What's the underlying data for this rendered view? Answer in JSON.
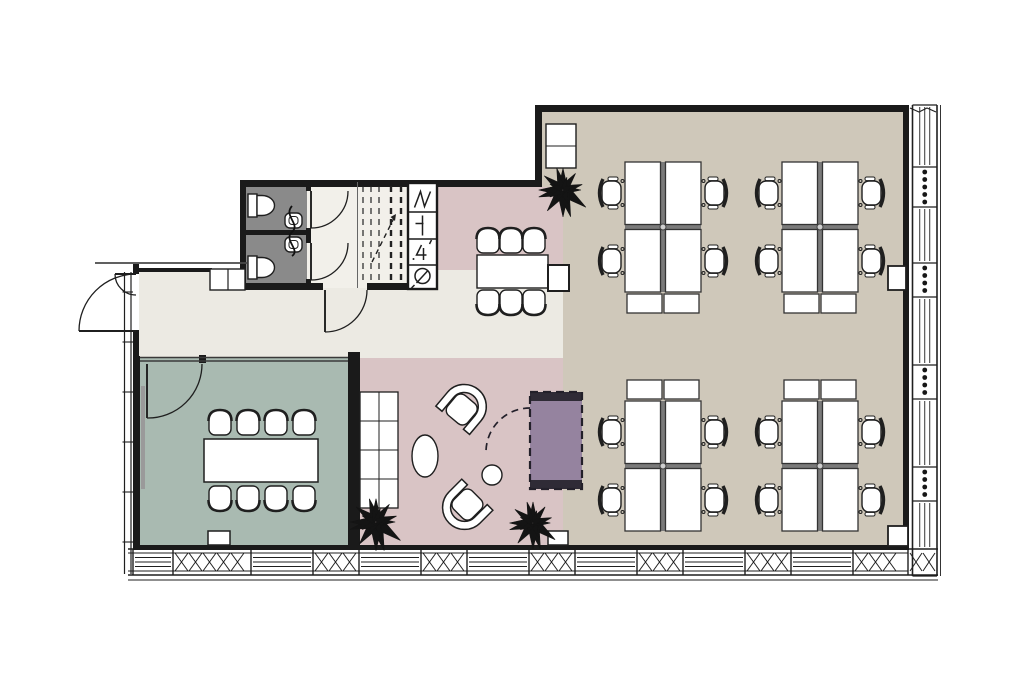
{
  "plan": {
    "canvas": {
      "width": 1024,
      "height": 683,
      "background": "#ffffff"
    },
    "palette": {
      "wall": "#1a1a1a",
      "line": "#1f1f1f",
      "office_floor": "#cfc8ba",
      "lounge_floor": "#d9c4c5",
      "meeting_floor": "#a9bab1",
      "corridor_floor": "#eceae3",
      "vestibule_floor": "#f2f0ea",
      "wc_floor": "#8a8a8a",
      "booth_fill": "#95839f",
      "booth_bar": "#2f2b36",
      "furniture_fill": "#ffffff",
      "desk_divider": "#7a7a7a",
      "whiteboard": "#9a9a9a",
      "glass": "#3a3a3a"
    },
    "rooms": [
      {
        "id": "open-office-a",
        "fill": "office_floor",
        "rect": [
          542,
          112,
          363,
          75
        ]
      },
      {
        "id": "open-office-b",
        "fill": "office_floor",
        "rect": [
          560,
          187,
          345,
          358
        ]
      },
      {
        "id": "lounge-upper",
        "fill": "lounge_floor",
        "rect": [
          437,
          187,
          126,
          103
        ]
      },
      {
        "id": "corridor",
        "fill": "corridor_floor",
        "rect": [
          139,
          270,
          424,
          88
        ]
      },
      {
        "id": "lounge",
        "fill": "lounge_floor",
        "rect": [
          360,
          358,
          203,
          187
        ]
      },
      {
        "id": "meeting-room",
        "fill": "meeting_floor",
        "rect": [
          140,
          358,
          208,
          187
        ]
      },
      {
        "id": "wc",
        "fill": "wc_floor",
        "rect": [
          245,
          182,
          62,
          105
        ]
      },
      {
        "id": "vestibule",
        "fill": "vestibule_floor",
        "rect": [
          307,
          182,
          50,
          106
        ]
      },
      {
        "id": "stair-bay",
        "fill": "vestibule_floor",
        "rect": [
          357,
          182,
          51,
          106
        ]
      }
    ],
    "walls": [
      {
        "id": "wall-office-top",
        "rect": [
          535,
          105,
          374,
          7
        ]
      },
      {
        "id": "wall-office-right",
        "rect": [
          903,
          105,
          6,
          445
        ]
      },
      {
        "id": "wall-office-left-upper",
        "rect": [
          535,
          105,
          7,
          82
        ]
      },
      {
        "id": "wall-wing-top",
        "rect": [
          240,
          180,
          302,
          7
        ]
      },
      {
        "id": "wall-wc-left",
        "rect": [
          240,
          180,
          6,
          110
        ]
      },
      {
        "id": "wall-wc-divider",
        "rect": [
          245,
          230,
          62,
          5
        ]
      },
      {
        "id": "wall-wc-right-a",
        "rect": [
          306,
          182,
          5,
          9
        ]
      },
      {
        "id": "wall-wc-right-b",
        "rect": [
          306,
          228,
          5,
          15
        ]
      },
      {
        "id": "wall-wc-right-c",
        "rect": [
          306,
          279,
          5,
          11
        ]
      },
      {
        "id": "wall-corridor-top-a",
        "rect": [
          240,
          283,
          83,
          7
        ]
      },
      {
        "id": "wall-corridor-top-b",
        "rect": [
          367,
          283,
          41,
          7
        ]
      },
      {
        "id": "wall-entry-top",
        "rect": [
          133,
          268,
          79,
          4
        ]
      },
      {
        "id": "wall-entry-left-a",
        "rect": [
          133,
          264,
          6,
          10
        ]
      },
      {
        "id": "wall-entry-left-b",
        "rect": [
          133,
          330,
          6,
          30
        ]
      },
      {
        "id": "wall-meeting-left",
        "rect": [
          133,
          356,
          7,
          189
        ]
      },
      {
        "id": "wall-meeting-right",
        "rect": [
          348,
          352,
          12,
          193
        ]
      },
      {
        "id": "wall-bottom",
        "rect": [
          133,
          545,
          776,
          5
        ]
      },
      {
        "id": "wall-glass-mullion",
        "rect": [
          199,
          355,
          7,
          8
        ]
      }
    ],
    "glass_wall": {
      "x0": 140,
      "x1": 348,
      "y": 359
    },
    "canopy": {
      "line": [
        95,
        263,
        247,
        263
      ]
    },
    "niche": {
      "rect": [
        210,
        269,
        35,
        21
      ],
      "divider_x": 228
    },
    "doors": [
      {
        "id": "door-entrance-main",
        "hinge": [
          136,
          331
        ],
        "leaf": [
          79,
          331
        ],
        "jamb": [
          136,
          274
        ]
      },
      {
        "id": "door-entrance-side",
        "hinge": [
          136,
          274
        ],
        "leaf": [
          115,
          274
        ],
        "jamb": [
          136,
          295
        ]
      },
      {
        "id": "door-meeting-room",
        "hinge": [
          147,
          364
        ],
        "leaf": [
          147,
          418
        ],
        "jamb": [
          202,
          364
        ]
      },
      {
        "id": "door-vestibule",
        "hinge": [
          325,
          290
        ],
        "leaf": [
          325,
          332
        ],
        "jamb": [
          367,
          290
        ]
      },
      {
        "id": "door-wc-1",
        "hinge": [
          311,
          191
        ],
        "leaf": [
          311,
          228
        ],
        "jamb": [
          348,
          191
        ]
      },
      {
        "id": "door-wc-2",
        "hinge": [
          311,
          243
        ],
        "leaf": [
          311,
          280
        ],
        "jamb": [
          348,
          243
        ]
      }
    ],
    "stairs": {
      "lines": [
        [
          363,
          186,
          363,
          282,
          1.2
        ],
        [
          371,
          186,
          371,
          282,
          1.2
        ],
        [
          379,
          186,
          379,
          282,
          1.2
        ],
        [
          391,
          186,
          391,
          282,
          2.4
        ],
        [
          401,
          186,
          401,
          282,
          2.4
        ]
      ],
      "divider": [
        357.5,
        182,
        357.5,
        288
      ],
      "arrow": [
        372,
        262,
        396,
        214
      ]
    },
    "shaft": {
      "rect": [
        408,
        183,
        29,
        106
      ],
      "dividers": [
        212,
        239,
        265
      ],
      "symbols": [
        "zigzag",
        "tee",
        "numeral-4",
        "fan"
      ]
    },
    "wc_fixtures": {
      "toilets": [
        [
          248,
          194
        ],
        [
          248,
          256
        ]
      ],
      "sinks": [
        [
          285,
          213
        ],
        [
          285,
          237
        ]
      ],
      "squiggle": [
        292,
        206,
        292,
        256
      ]
    },
    "desk_cluster_spec": {
      "block_w": 76,
      "block_h": 130,
      "gap": 5,
      "cab_w": 35,
      "cab_h": 19,
      "chair_dx_left": -14,
      "chair_dx_right": 90,
      "chair_dy": [
        31,
        99
      ]
    },
    "desk_clusters": [
      {
        "id": "desk-cluster-1",
        "origin": [
          625,
          162
        ],
        "cabinets": "below"
      },
      {
        "id": "desk-cluster-2",
        "origin": [
          782,
          162
        ],
        "cabinets": "below"
      },
      {
        "id": "desk-cluster-3",
        "origin": [
          625,
          401
        ],
        "cabinets": "above"
      },
      {
        "id": "desk-cluster-4",
        "origin": [
          782,
          401
        ],
        "cabinets": "above"
      }
    ],
    "meeting_room": {
      "table": [
        204,
        439,
        114,
        43
      ],
      "chair_xs": [
        220,
        248,
        276,
        304
      ],
      "chairs_top_y": 424,
      "chairs_bottom_y": 497,
      "whiteboard": [
        141,
        386,
        4,
        103
      ],
      "floor_box": [
        208,
        531,
        22,
        14
      ]
    },
    "top_meeting": {
      "table": [
        477,
        255,
        71,
        33
      ],
      "side_table": [
        548,
        265,
        21,
        26
      ],
      "chair_xs": [
        488,
        511,
        534
      ],
      "chairs_top_y": 242,
      "chairs_bottom_y": 301
    },
    "lounge": {
      "shelf": {
        "rect": [
          360,
          392,
          38,
          116
        ],
        "cols": 2,
        "rows": 4
      },
      "armchairs": [
        {
          "cx": 463,
          "cy": 408,
          "rot": 40
        },
        {
          "cx": 466,
          "cy": 506,
          "rot": 225
        }
      ],
      "oval_table": [
        425,
        456,
        13,
        21
      ],
      "round_table": [
        492,
        475,
        10
      ],
      "floor_box": [
        548,
        531,
        20,
        14
      ]
    },
    "booth": {
      "rect": [
        530,
        392,
        52,
        97
      ],
      "bar_h": 9,
      "door_arc": {
        "start": [
          530,
          408
        ],
        "end": [
          486,
          452
        ],
        "r": 44
      }
    },
    "office_extras": {
      "cabinet": {
        "rect": [
          546,
          124,
          30,
          44
        ],
        "divider_y": 146
      },
      "wall_boxes": [
        [
          888,
          266,
          18,
          24
        ],
        [
          888,
          526,
          20,
          20
        ]
      ]
    },
    "plants": [
      {
        "cx": 563,
        "cy": 190,
        "r": 29
      },
      {
        "cx": 376,
        "cy": 522,
        "r": 31
      },
      {
        "cx": 533,
        "cy": 523,
        "r": 28
      }
    ],
    "windows": {
      "bottom": {
        "x0": 128,
        "x1": 938,
        "top": 549,
        "inner_top": 553,
        "inner_bottom": 571,
        "bot": 575,
        "sill": 580,
        "sections": [
          [
            133,
            40,
            "plain"
          ],
          [
            173,
            78,
            "x"
          ],
          [
            251,
            62,
            "plain"
          ],
          [
            313,
            46,
            "x"
          ],
          [
            359,
            62,
            "plain"
          ],
          [
            421,
            46,
            "x"
          ],
          [
            467,
            62,
            "plain"
          ],
          [
            529,
            46,
            "x"
          ],
          [
            575,
            62,
            "plain"
          ],
          [
            637,
            46,
            "x"
          ],
          [
            683,
            62,
            "plain"
          ],
          [
            745,
            46,
            "x"
          ],
          [
            791,
            62,
            "plain"
          ],
          [
            853,
            55,
            "x"
          ]
        ]
      },
      "right": {
        "y0": 105,
        "y1": 576,
        "left": 912.5,
        "right": 937,
        "outer": 940.5,
        "sections": [
          [
            105,
            62,
            "plain"
          ],
          [
            167,
            40,
            "dots"
          ],
          [
            207,
            56,
            "plain"
          ],
          [
            263,
            34,
            "dots"
          ],
          [
            297,
            68,
            "plain"
          ],
          [
            365,
            34,
            "dots"
          ],
          [
            399,
            68,
            "plain"
          ],
          [
            467,
            34,
            "dots"
          ],
          [
            501,
            48,
            "plain"
          ]
        ]
      },
      "left": {
        "x": 124.5,
        "x2": 131,
        "y0": 272,
        "y1": 574,
        "ticks": [
          292,
          342,
          392,
          442,
          492,
          542
        ]
      },
      "corner": [
        908,
        549,
        30,
        26
      ],
      "joint": [
        910,
        108,
        936,
        112
      ]
    }
  }
}
